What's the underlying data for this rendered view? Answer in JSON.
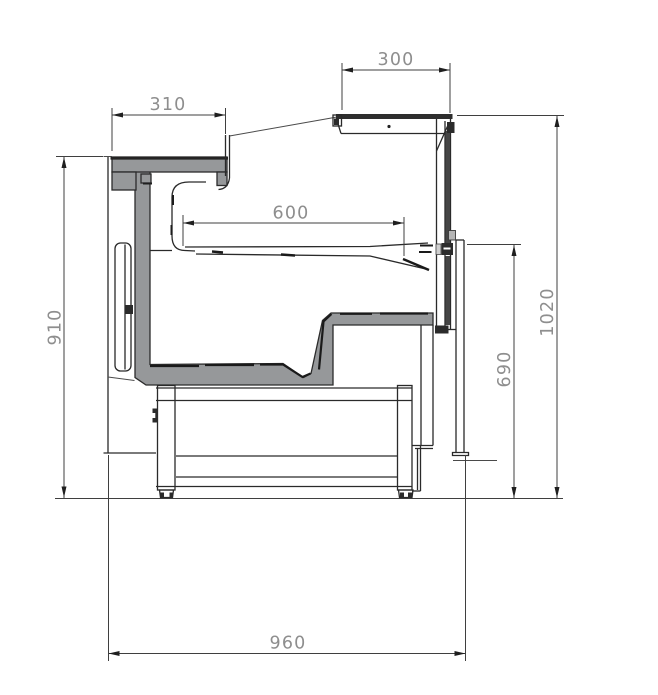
{
  "drawing": {
    "type": "CAD cross-section",
    "subject": "Serve-over refrigerated display counter, side section with dimension annotations",
    "background_color": "#ffffff",
    "line_color": "#2a2a2a",
    "dimension_text_color": "#8e8e8e",
    "insulation_fill_color": "#96989a",
    "dimensions": [
      {
        "id": "countertop-depth",
        "label": "310",
        "orientation": "horizontal"
      },
      {
        "id": "canopy-depth",
        "label": "300",
        "orientation": "horizontal"
      },
      {
        "id": "deck-depth",
        "label": "600",
        "orientation": "horizontal"
      },
      {
        "id": "countertop-height",
        "label": "910",
        "orientation": "vertical"
      },
      {
        "id": "overall-height",
        "label": "1020",
        "orientation": "vertical"
      },
      {
        "id": "front-height",
        "label": "690",
        "orientation": "vertical"
      },
      {
        "id": "overall-depth",
        "label": "960",
        "orientation": "horizontal"
      }
    ]
  }
}
